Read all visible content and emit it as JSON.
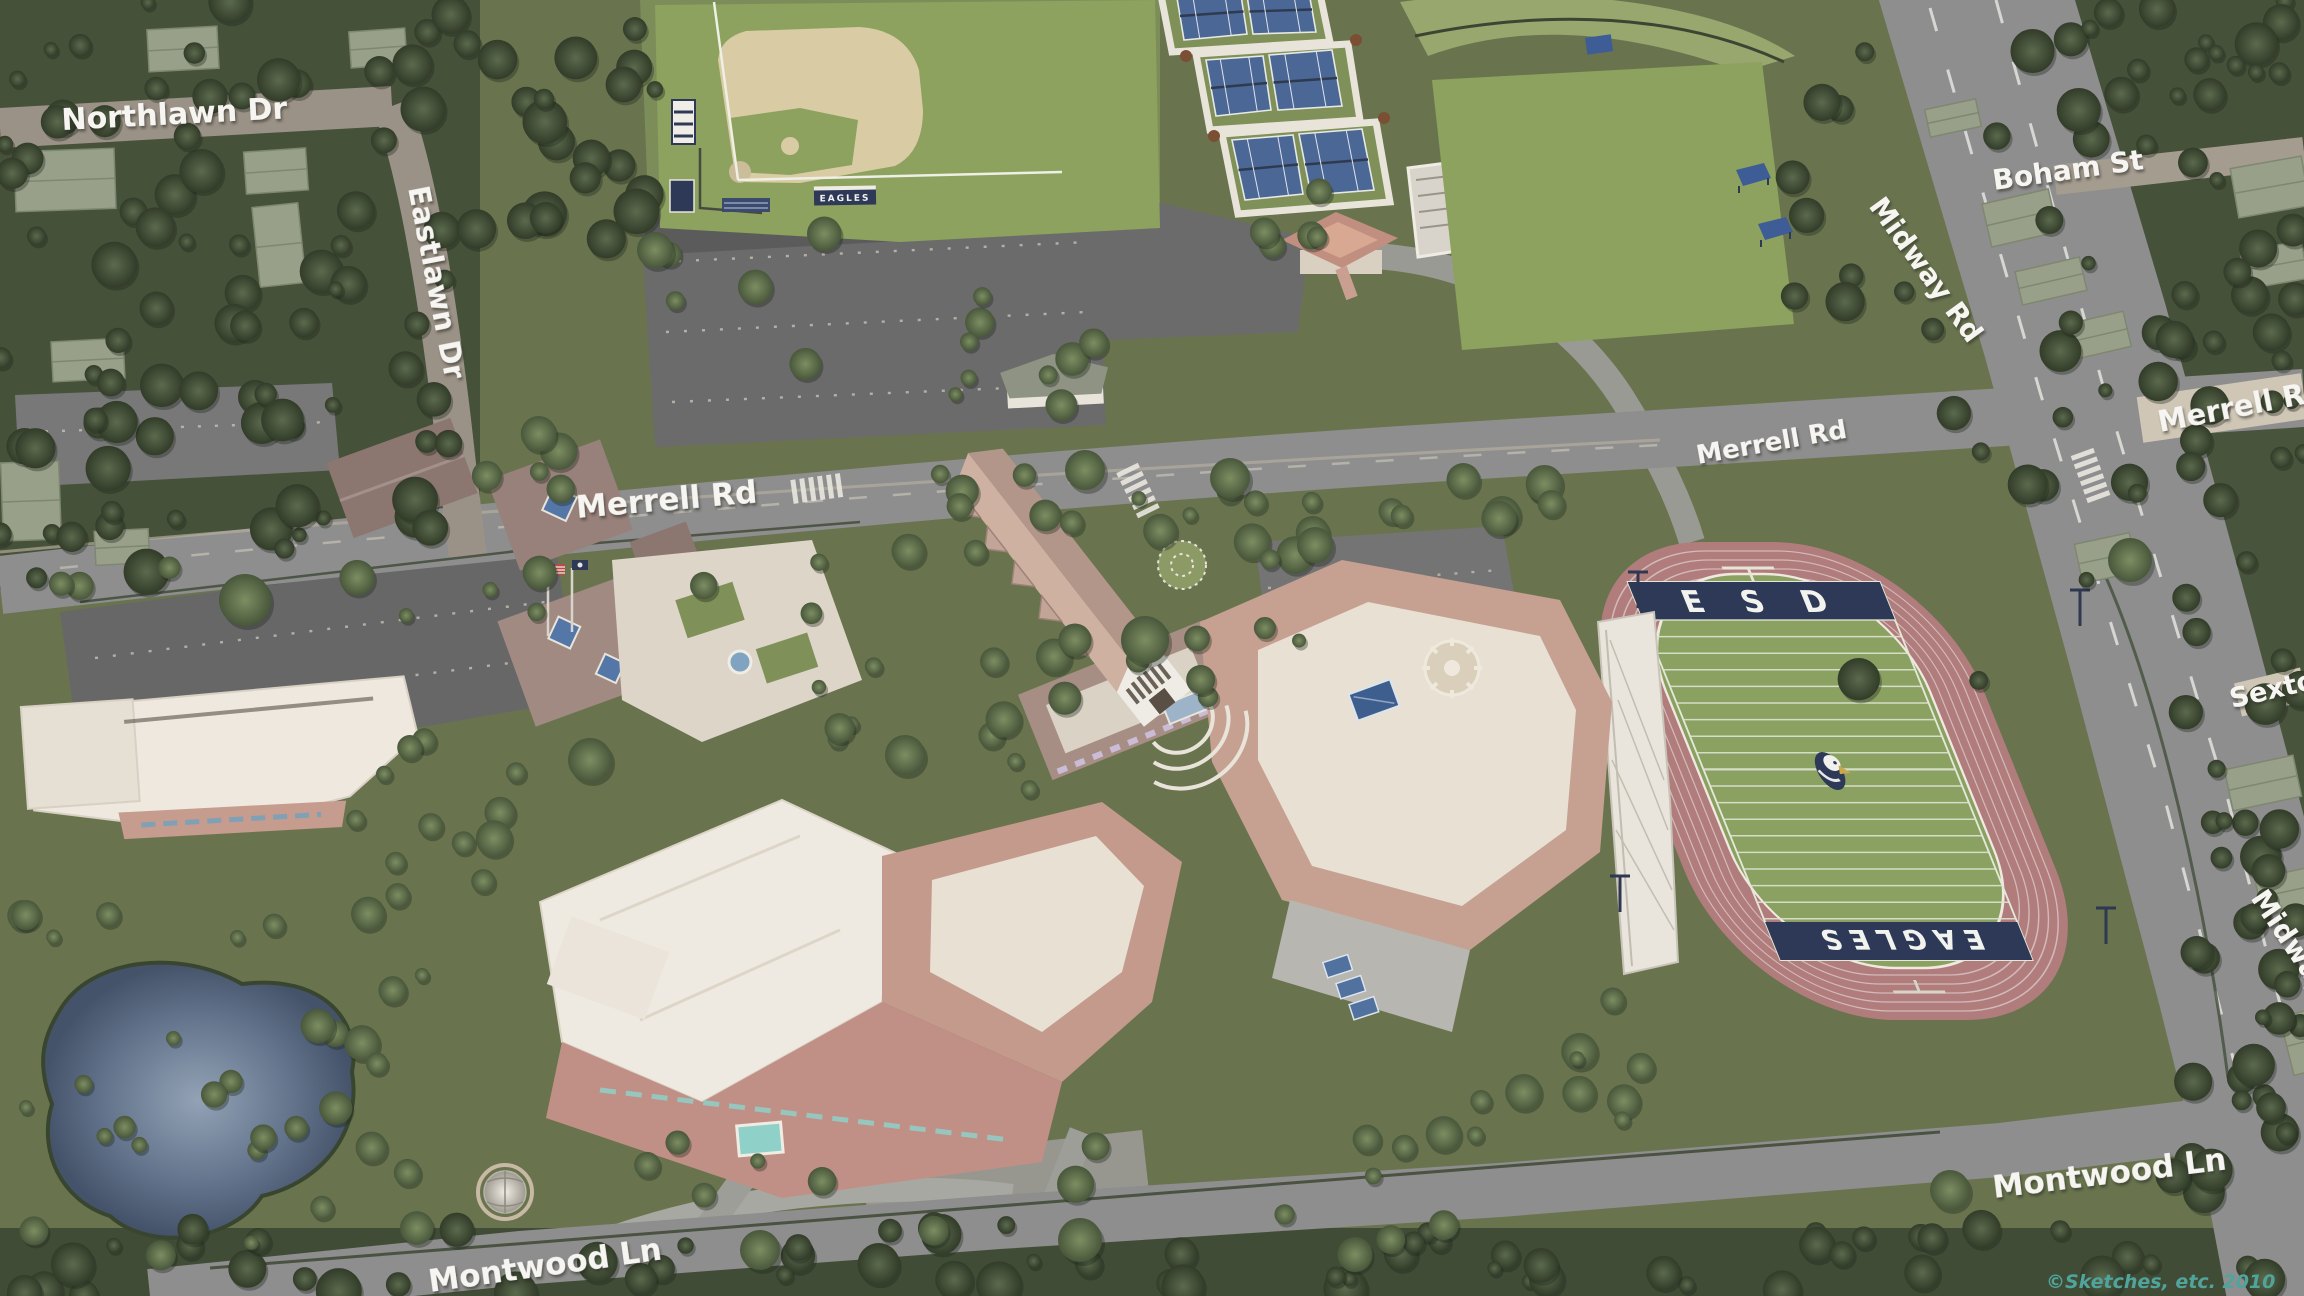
{
  "map": {
    "type": "illustrated-aerial-campus-map",
    "credit": {
      "text": "©Sketches, etc. 2010",
      "color": "#4fa49b"
    }
  },
  "streets": {
    "northlawn": {
      "text": "Northlawn Dr"
    },
    "eastlawn": {
      "text": "Eastlawn Dr"
    },
    "merrell_west": {
      "text": "Merrell Rd"
    },
    "merrell_center": {
      "text": "Merrell Rd"
    },
    "merrell_east": {
      "text": "Merrell Rd"
    },
    "boham": {
      "text": "Boham St"
    },
    "midway_north": {
      "text": "Midway Rd"
    },
    "midway_south": {
      "text": "Midway Rd"
    },
    "sexton": {
      "text": "Sexton"
    },
    "montwood_east": {
      "text": "Montwood Ln"
    },
    "montwood_west": {
      "text": "Montwood Ln"
    }
  },
  "stadium": {
    "end_zone_top": "E S D",
    "end_zone_bottom": "EAGLES",
    "mascot": "eagle-head-logo"
  },
  "baseball": {
    "scoreboard_sign": "EAGLES"
  },
  "palette": {
    "grass": "#69744f",
    "bright_field": "#8ca25e",
    "dark_foliage": "#3c4631",
    "road_gray": "#8e8e8e",
    "road_tan": "#9b9287",
    "road_light": "#cfc6b6",
    "parking": "#6e6e6e",
    "track": "#b17c7c",
    "field_green": "#8aa161",
    "endzone_navy": "#2d3956",
    "tennis_blue": "#4a6795",
    "pond": "#4e5d74",
    "roof_cream": "#eee8de",
    "roof_salmon": "#c39a8c",
    "roof_mauve": "#97817a",
    "label_white": "#f6f5f1"
  }
}
